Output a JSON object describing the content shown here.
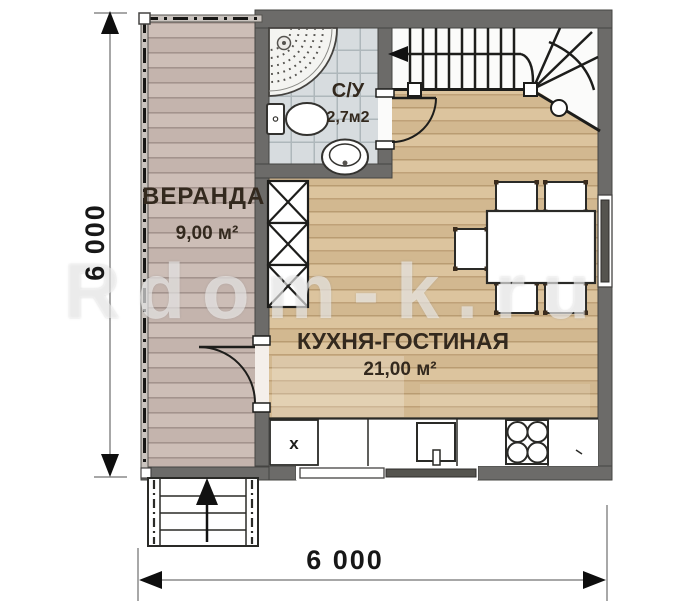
{
  "plan": {
    "watermark": "Rdom-k.ru",
    "rooms": {
      "veranda": {
        "name": "ВЕРАНДА",
        "area": "9,00 м²"
      },
      "bathroom": {
        "name": "С/У",
        "area": "2,7м2"
      },
      "kitchen_living": {
        "name": "КУХНЯ-ГОСТИНАЯ",
        "area": "21,00 м²"
      }
    },
    "dimensions": {
      "width_label": "6 000",
      "height_label": "6 000"
    },
    "kitchen": {
      "unit_label": "x"
    },
    "fixtures": [
      "corner-shower",
      "toilet",
      "washbasin",
      "winder-staircase",
      "wardrobe",
      "dining-table-5-chairs",
      "kitchen-counter",
      "kitchen-sink",
      "stove-4-burner",
      "entry-steps"
    ],
    "colors": {
      "wall": "#6c6b69",
      "veranda_floor": "#c9b9b2",
      "kitchen_floor": "#d8bf99",
      "bathroom_tile": "#d7dcdf"
    }
  }
}
